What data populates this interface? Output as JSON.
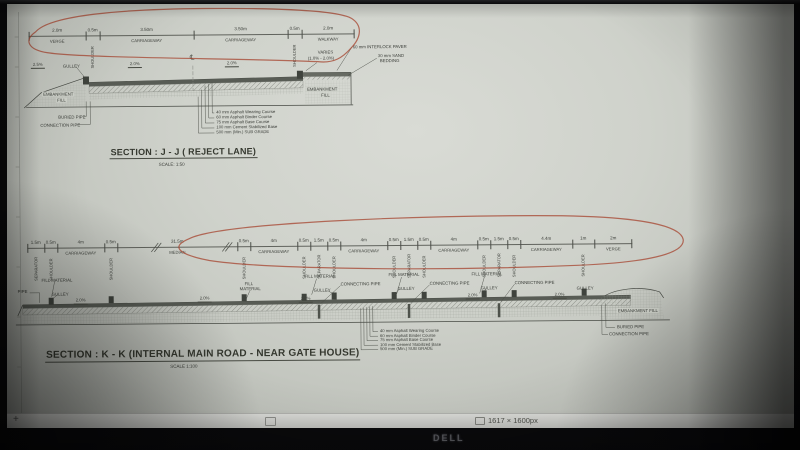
{
  "monitor": {
    "brand": "DELL"
  },
  "status_bar": {
    "zoom_in": "+",
    "image_size": "1617 × 1600px"
  },
  "pavement_layers": [
    "40 mm Asphalt Wearing Course",
    "60 mm Asphalt  Binder Course",
    "75 mm Asphalt Base Course",
    "100 mm Cement Stabilized Base",
    "500 mm (Min.) SUB GRADE"
  ],
  "section_jj": {
    "title": "SECTION : J - J ( REJECT LANE)",
    "scale": "SCALE: 1:50",
    "dims": [
      {
        "len": "2.0m",
        "label": "VERGE",
        "w": 57
      },
      {
        "len": "0.5m",
        "label": "SHOULDER",
        "w": 14,
        "rot": true
      },
      {
        "len": "3.50m",
        "label": "CARRIAGEWAY",
        "w": 94
      },
      {
        "len": "3.50m",
        "label": "CARRIAGEWAY",
        "w": 94
      },
      {
        "len": "0.5m",
        "label": "SHOULDER",
        "w": 14,
        "rot": true
      },
      {
        "len": "2.0m",
        "label": "WALKWAY",
        "w": 53
      }
    ],
    "annotations": [
      {
        "t": "GULLEY",
        "x": 57,
        "y": 57,
        "n": "gulley-label"
      },
      {
        "t": "2.5%",
        "x": 25,
        "y": 55,
        "c": "slope",
        "n": "slope-label"
      },
      {
        "t": "2.0%",
        "x": 122,
        "y": 55,
        "c": "slope",
        "n": "slope-label"
      },
      {
        "t": "2.0%",
        "x": 219,
        "y": 55,
        "c": "slope",
        "n": "slope-label"
      },
      {
        "t": "℄",
        "x": 184,
        "y": 49,
        "c": "cl",
        "n": "centerline-symbol"
      },
      {
        "t": "VARIES",
        "x": 312,
        "y": 45,
        "n": "varies-label"
      },
      {
        "t": "(1.0% - 2.0%)",
        "x": 302,
        "y": 51,
        "n": "varies-range-label"
      },
      {
        "t": "60 mm INTERLOCK PAVER",
        "x": 347,
        "y": 40,
        "n": "interlock-paver-label"
      },
      {
        "t": "30 mm SAND",
        "x": 372,
        "y": 49,
        "n": "sand-bedding-label"
      },
      {
        "t": "BEDDING",
        "x": 374,
        "y": 54,
        "n": "sand-bedding-label"
      },
      {
        "t": "EMBANKMENT",
        "x": 36,
        "y": 85,
        "c": "chip",
        "n": "embankment-fill-label"
      },
      {
        "t": "FILL",
        "x": 50,
        "y": 91,
        "c": "chip",
        "n": "embankment-fill-label"
      },
      {
        "t": "EMBANKMENT",
        "x": 300,
        "y": 82,
        "c": "chip",
        "n": "embankment-fill-label"
      },
      {
        "t": "FILL",
        "x": 314,
        "y": 88,
        "c": "chip",
        "n": "embankment-fill-label"
      },
      {
        "t": "BURIED PIPE",
        "x": 52,
        "y": 108,
        "n": "buried-pipe-label"
      },
      {
        "t": "CONNECTION PIPE",
        "x": 34,
        "y": 116,
        "n": "connection-pipe-label"
      }
    ]
  },
  "section_kk": {
    "title": "SECTION : K - K (INTERNAL MAIN ROAD - NEAR GATE HOUSE)",
    "scale": "SCALE 1:100",
    "dims": [
      {
        "len": "1.5m",
        "label": "SEPARATOR",
        "w": 17,
        "rot": true
      },
      {
        "len": "0.5m",
        "label": "SHOULDER",
        "w": 13,
        "rot": true
      },
      {
        "len": "4m",
        "label": "CARRIAGEWAY",
        "w": 47
      },
      {
        "len": "0.5m",
        "label": "SHOULDER",
        "w": 13,
        "rot": true
      },
      {
        "len": "31.5m",
        "label": "MEDIAN",
        "w": 120
      },
      {
        "len": "0.5m",
        "label": "SHOULDER",
        "w": 13,
        "rot": true
      },
      {
        "len": "4m",
        "label": "CARRIAGEWAY",
        "w": 47
      },
      {
        "len": "0.5m",
        "label": "SHOULDER",
        "w": 13,
        "rot": true
      },
      {
        "len": "1.5m",
        "label": "SEPARATOR",
        "w": 17,
        "rot": true
      },
      {
        "len": "0.5m",
        "label": "SHOULDER",
        "w": 13,
        "rot": true
      },
      {
        "len": "4m",
        "label": "CARRIAGEWAY",
        "w": 47
      },
      {
        "len": "0.5m",
        "label": "SHOULDER",
        "w": 13,
        "rot": true
      },
      {
        "len": "1.5m",
        "label": "SEPARATOR",
        "w": 17,
        "rot": true
      },
      {
        "len": "0.5m",
        "label": "SHOULDER",
        "w": 13,
        "rot": true
      },
      {
        "len": "4m",
        "label": "CARRIAGEWAY",
        "w": 47
      },
      {
        "len": "0.5m",
        "label": "SHOULDER",
        "w": 13,
        "rot": true
      },
      {
        "len": "1.5m",
        "label": "SEPARATOR",
        "w": 17,
        "rot": true
      },
      {
        "len": "0.5m",
        "label": "SHOULDER",
        "w": 13,
        "rot": true
      },
      {
        "len": "4.4m",
        "label": "CARRIAGEWAY",
        "w": 52
      },
      {
        "len": "1m",
        "label": "SHOULDER",
        "w": 22,
        "rot": true
      },
      {
        "len": "2m",
        "label": "VERGE",
        "w": 38
      }
    ],
    "annotations": [
      {
        "t": "PIPE",
        "x": 10,
        "y": 282,
        "n": "pipe-label"
      },
      {
        "t": "FILL MATERIAL",
        "x": 34,
        "y": 271,
        "n": "fill-material-label"
      },
      {
        "t": "GULLEY",
        "x": 44,
        "y": 285,
        "n": "gulley-label"
      },
      {
        "t": "2.0%",
        "x": 66,
        "y": 291,
        "c": "slope",
        "n": "slope-label"
      },
      {
        "t": "FILL",
        "x": 237,
        "y": 276,
        "n": "fill-material-label"
      },
      {
        "t": "MATERIAL",
        "x": 232,
        "y": 281,
        "n": "fill-material-label"
      },
      {
        "t": "2.0%",
        "x": 190,
        "y": 290,
        "c": "slope",
        "n": "slope-label"
      },
      {
        "t": "FILL MATERIAL",
        "x": 297,
        "y": 269,
        "n": "fill-material-label"
      },
      {
        "t": "GULLEY",
        "x": 306,
        "y": 283,
        "n": "gulley-label"
      },
      {
        "t": "CONNECTING PIPE",
        "x": 333,
        "y": 277,
        "n": "connecting-pipe-label"
      },
      {
        "t": "FILL MATERIAL",
        "x": 381,
        "y": 268,
        "n": "fill-material-label"
      },
      {
        "t": "GULLEY",
        "x": 390,
        "y": 282,
        "n": "gulley-label"
      },
      {
        "t": "2.0%",
        "x": 291,
        "y": 291,
        "c": "slope",
        "n": "slope-label"
      },
      {
        "t": "CONNECTING PIPE",
        "x": 422,
        "y": 277,
        "n": "connecting-pipe-label"
      },
      {
        "t": "FILL MATERIAL",
        "x": 464,
        "y": 268,
        "n": "fill-material-label"
      },
      {
        "t": "GULLEY",
        "x": 473,
        "y": 282,
        "n": "gulley-label"
      },
      {
        "t": "CONNECTING PIPE",
        "x": 507,
        "y": 277,
        "n": "connecting-pipe-label"
      },
      {
        "t": "2.0%",
        "x": 458,
        "y": 289,
        "c": "slope",
        "n": "slope-label"
      },
      {
        "t": "2.0%",
        "x": 545,
        "y": 289,
        "c": "slope",
        "n": "slope-label"
      },
      {
        "t": "GULLEY",
        "x": 569,
        "y": 283,
        "n": "gulley-label"
      },
      {
        "t": "EMBANKMENT FILL",
        "x": 609,
        "y": 306,
        "c": "chip",
        "n": "embankment-fill-label"
      },
      {
        "t": "BURIED PIPE",
        "x": 609,
        "y": 322,
        "n": "buried-pipe-label"
      },
      {
        "t": "CONNECTION PIPE",
        "x": 601,
        "y": 329,
        "n": "connection-pipe-label"
      }
    ]
  }
}
